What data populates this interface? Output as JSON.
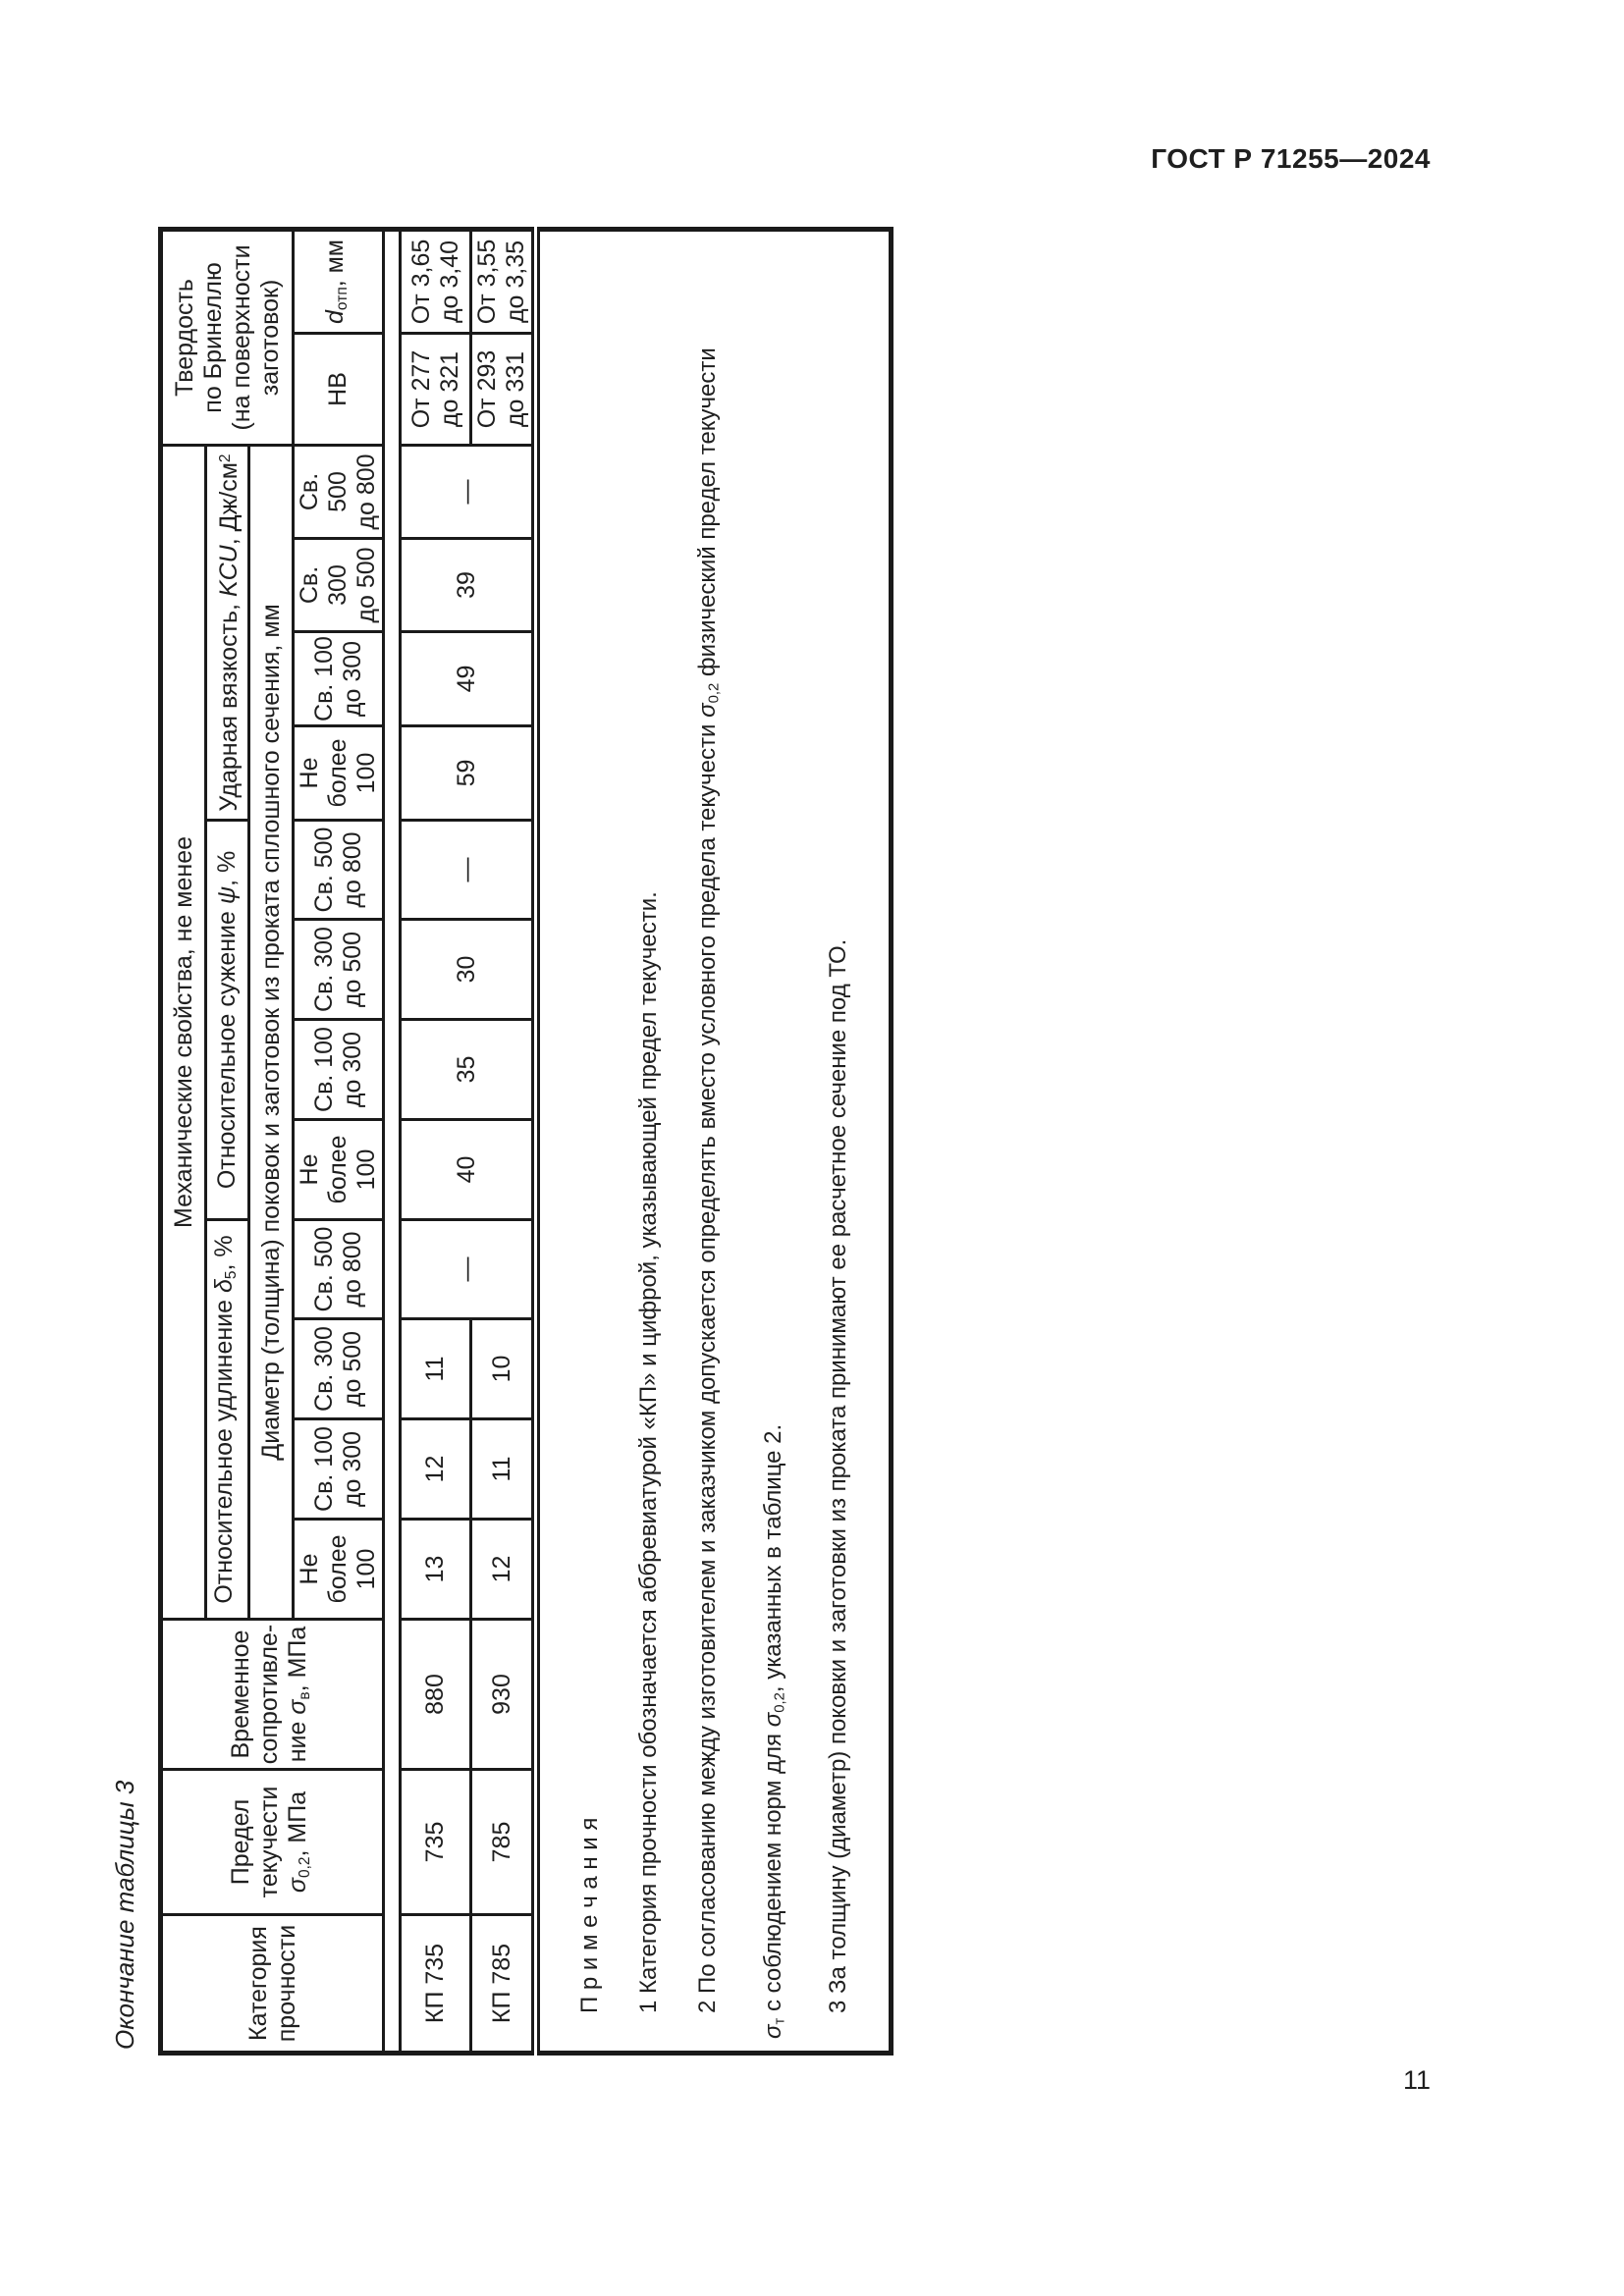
{
  "page": {
    "doc_header": "ГОСТ Р 71255—2024",
    "page_number": "11",
    "table_caption": "Окончание таблицы 3"
  },
  "sym": {
    "sigma": "σ",
    "delta": "δ",
    "psi": "ψ",
    "d": "d",
    "kcu": "KCU",
    "sub02": "0,2",
    "subv": "в",
    "subt": "т",
    "sub5": "5",
    "subotp": "отп",
    "sup2": "2"
  },
  "table": {
    "header": {
      "category": "Категория\nпрочности",
      "yield_top": "Предел\nтекучести",
      "yield_unit": ", МПа",
      "tensile_top": "Временное\nсопротивле-",
      "tensile_prefix": "ние ",
      "tensile_unit": ", МПа",
      "mech": "Механические свойства, не менее",
      "elong_prefix": "Относительное удлинение ",
      "pct_unit": ", %",
      "contraction_prefix": "Относительное сужение ",
      "impact_prefix": "Ударная вязкость, ",
      "impact_unit": ", Дж/см",
      "diameter": "Диаметр (толщина) поковок и заготовок из проката сплошного сечения, мм",
      "hardness": "Твердость\nпо Бринеллю\n(на поверхности\nзаготовок)",
      "hb": "НВ",
      "dotp_unit": ", мм"
    },
    "size_cols": [
      "Не более\n100",
      "Св. 100\nдо 300",
      "Св. 300\nдо 500",
      "Св. 500\nдо 800"
    ],
    "rows": [
      {
        "category": "КП 735",
        "yield": "735",
        "tensile": "880",
        "elong": [
          "13",
          "12",
          "11"
        ],
        "hb": "От 277\nдо 321",
        "dotp": "От 3,65\nдо 3,40"
      },
      {
        "category": "КП 785",
        "yield": "785",
        "tensile": "930",
        "elong": [
          "12",
          "11",
          "10"
        ],
        "hb": "От 293\nдо 331",
        "dotp": "От 3,55\nдо 3,35"
      }
    ],
    "merged": {
      "elong_dash": "—",
      "contraction": [
        "40",
        "35",
        "30",
        "—"
      ],
      "impact": [
        "59",
        "49",
        "39",
        "—"
      ]
    },
    "notes": {
      "title": "П р и м е ч а н и я",
      "n1": "1 Категория прочности обозначается аббревиатурой «КП» и цифрой, указывающей предел текучести.",
      "n2a": "2 По согласованию между изготовителем и заказчиком допускается определять вместо условного предела текучести ",
      "n2b": " физический предел текучести",
      "n2c": " с соблюдением норм для ",
      "n2d": ", указанных в таблице 2.",
      "n3": "3 За толщину (диаметр) поковки и заготовки из проката принимают ее расчетное сечение под ТО."
    }
  }
}
